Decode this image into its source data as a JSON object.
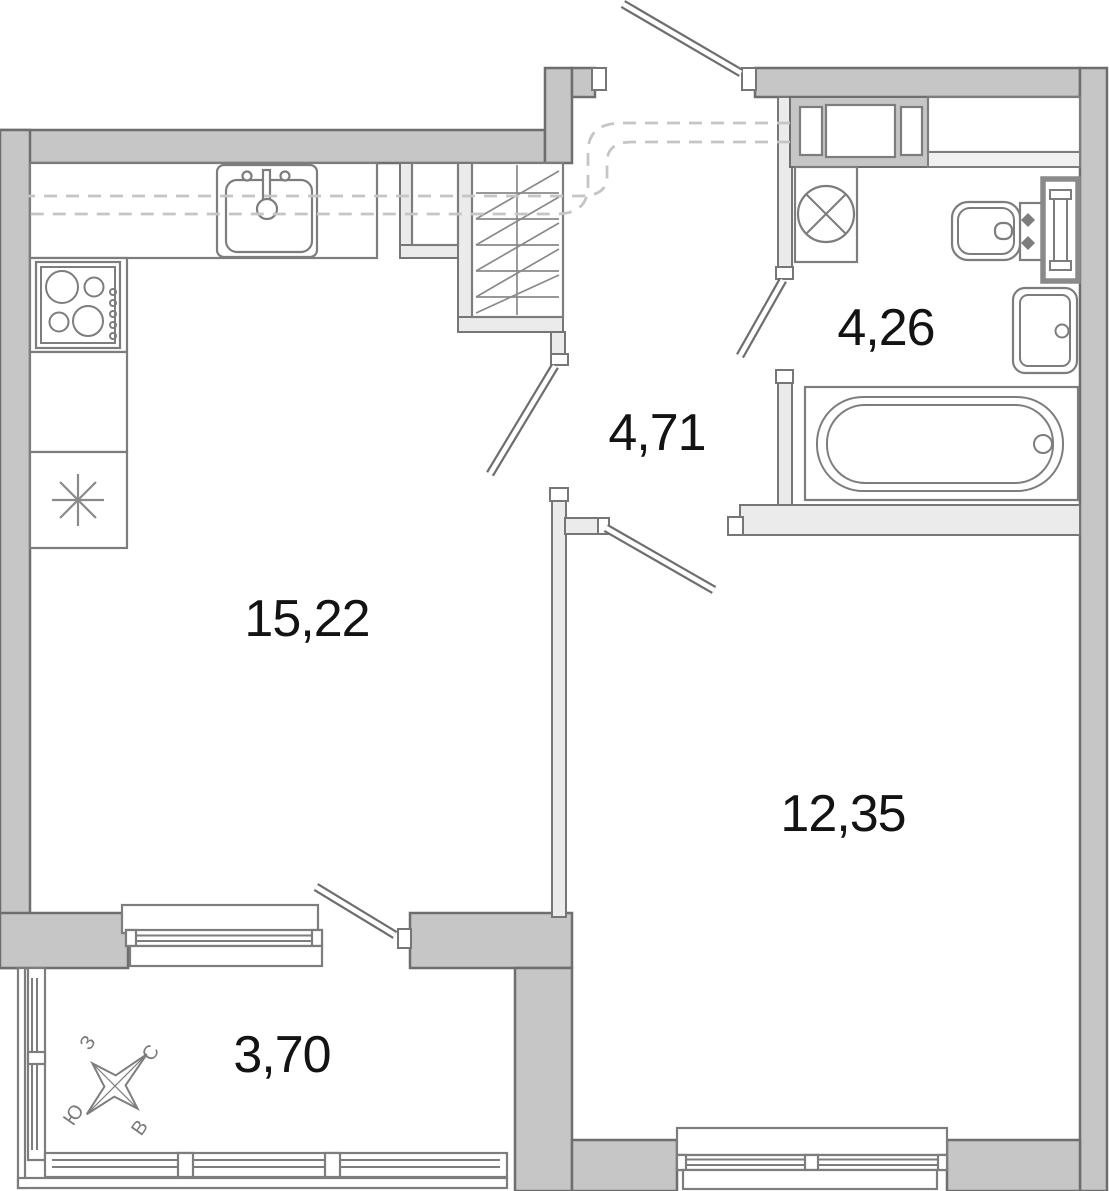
{
  "labels": {
    "living_kitchen_area": "15,22",
    "hallway_area": "4,71",
    "bathroom_area": "4,26",
    "bedroom_area": "12,35",
    "balcony_area": "3,70"
  },
  "compass": {
    "north": "С",
    "south": "Ю",
    "west": "З",
    "east": "В"
  },
  "icons": [
    "kitchen-sink-icon",
    "stove-icon",
    "fridge-snowflake-icon",
    "wardrobe-hatch-icon",
    "washing-machine-icon",
    "toilet-icon",
    "towel-rail-icon",
    "washbasin-icon",
    "bathtub-icon",
    "window-icon",
    "door-leaf-icon",
    "compass-rose-icon"
  ],
  "colors": {
    "exterior_wall": "#c6c6c6",
    "interior_partition": "#ebebeb",
    "wall_outline": "#6e6e6e",
    "fixture_outline": "#7d7d7d",
    "duct_dash": "#c5c5c5",
    "label_text": "#131313",
    "compass_text": "#7b7b7b"
  }
}
